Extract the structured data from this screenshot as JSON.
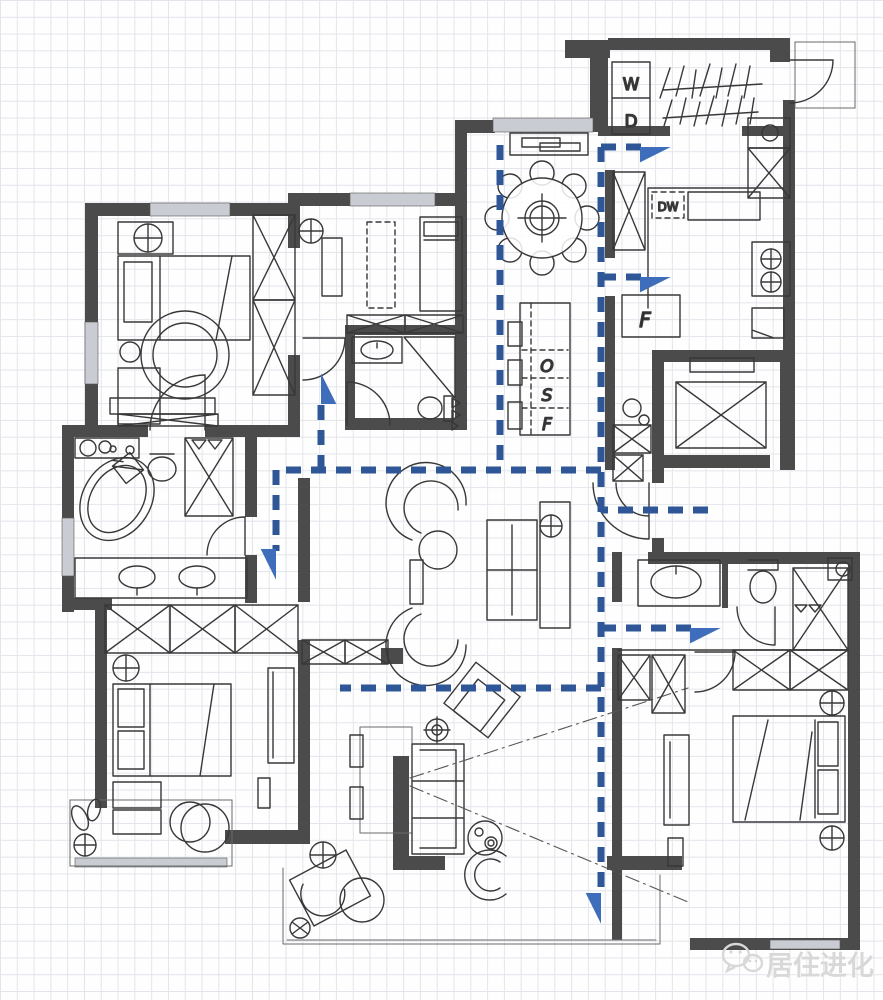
{
  "page": {
    "width": 883,
    "height": 1000,
    "kind": "hand-drawn apartment floor plan on grid paper with circulation arrows"
  },
  "colors": {
    "wall": "#4b4b4b",
    "sketch": "#383838",
    "grid": "#e2e5eb",
    "window": "#c9ccd2",
    "circulation": "#2f5797",
    "arrowhead": "#3e6dbb",
    "watermark": "#d8d8d8"
  },
  "labels": {
    "washer": "W",
    "dryer": "D",
    "dishwasher": "DW",
    "fridge": "F",
    "tall_cabinet": [
      "O",
      "S",
      "F"
    ]
  },
  "watermark": {
    "text": "居住进化"
  },
  "circulation": {
    "stroke_width": 7,
    "dash": "15 10",
    "arrows": [
      {
        "name": "spine-to-balcony",
        "points": [
          [
            601,
            147
          ],
          [
            601,
            895
          ]
        ],
        "head": true
      },
      {
        "name": "to-laundry",
        "points": [
          [
            601,
            147
          ],
          [
            642,
            147
          ]
        ],
        "head": true
      },
      {
        "name": "to-kitchen",
        "points": [
          [
            601,
            277
          ],
          [
            642,
            277
          ]
        ],
        "head": true
      },
      {
        "name": "entry-feed",
        "points": [
          [
            708,
            510
          ],
          [
            601,
            510
          ]
        ],
        "head": false
      },
      {
        "name": "to-ensuite-bedroom",
        "points": [
          [
            601,
            628
          ],
          [
            692,
            628
          ]
        ],
        "head": true
      },
      {
        "name": "corridor-to-master",
        "points": [
          [
            601,
            470
          ],
          [
            276,
            470
          ],
          [
            276,
            551
          ]
        ],
        "head": true
      },
      {
        "name": "to-north-bedroom",
        "points": [
          [
            321,
            470
          ],
          [
            321,
            402
          ]
        ],
        "head": true
      },
      {
        "name": "dining-lane-west",
        "points": [
          [
            500,
            145
          ],
          [
            500,
            470
          ]
        ],
        "head": false
      },
      {
        "name": "to-living",
        "points": [
          [
            601,
            688
          ],
          [
            340,
            688
          ]
        ],
        "head": false
      }
    ]
  }
}
